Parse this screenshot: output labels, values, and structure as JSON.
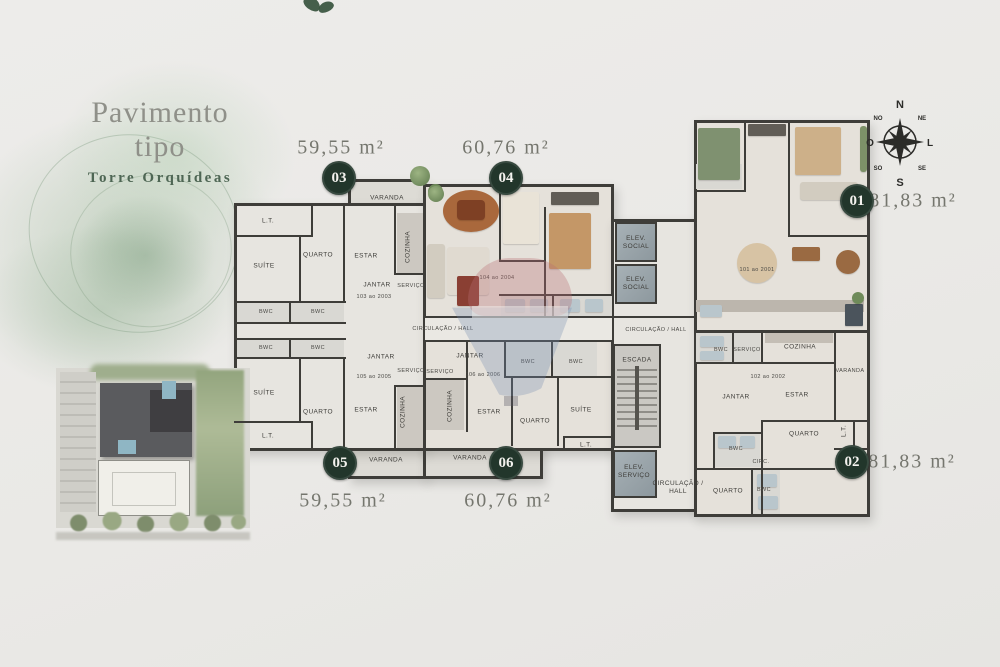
{
  "title_block": {
    "title": "Pavimento tipo",
    "subtitle": "Torre Orquídeas"
  },
  "units": [
    {
      "number": "03",
      "area": "59,55 m²"
    },
    {
      "number": "04",
      "area": "60,76 m²"
    },
    {
      "number": "01",
      "area": "81,83 m²"
    },
    {
      "number": "05",
      "area": "59,55 m²"
    },
    {
      "number": "06",
      "area": "60,76 m²"
    },
    {
      "number": "02",
      "area": "81,83 m²"
    }
  ],
  "compass": {
    "n": "N",
    "ne": "NE",
    "l": "L",
    "se": "SE",
    "s": "S",
    "so": "SO",
    "o": "O",
    "no": "NO"
  },
  "colors": {
    "badge_green": "#22362b",
    "subtitle_green": "#4e6654",
    "title_gray": "#8f9089",
    "area_text": "#75766e",
    "wall": "#3e3d39"
  },
  "plan": {
    "room_labels": [
      {
        "text": "VARANDA",
        "x": 387,
        "y": 198
      },
      {
        "text": "L.T.",
        "x": 268,
        "y": 221
      },
      {
        "text": "SUÍTE",
        "x": 264,
        "y": 266
      },
      {
        "text": "QUARTO",
        "x": 318,
        "y": 255
      },
      {
        "text": "ESTAR",
        "x": 366,
        "y": 256
      },
      {
        "text": "COZINHA",
        "x": 408,
        "y": 247,
        "rot": 1
      },
      {
        "text": "JANTAR",
        "x": 377,
        "y": 285
      },
      {
        "text": "103 ao 2003",
        "x": 374,
        "y": 297,
        "size": "xs"
      },
      {
        "text": "SERVIÇO",
        "x": 411,
        "y": 286,
        "size": "xs"
      },
      {
        "text": "BWC",
        "x": 266,
        "y": 312,
        "size": "xs"
      },
      {
        "text": "BWC",
        "x": 318,
        "y": 312,
        "size": "xs"
      },
      {
        "text": "104 ao 2004",
        "x": 497,
        "y": 278,
        "size": "xs"
      },
      {
        "text": "CIRCULAÇÃO / HALL",
        "x": 443,
        "y": 329,
        "size": "xs"
      },
      {
        "text": "CIRCULAÇÃO / HALL",
        "x": 656,
        "y": 330,
        "size": "xs"
      },
      {
        "text": "BWC",
        "x": 266,
        "y": 348,
        "size": "xs"
      },
      {
        "text": "BWC",
        "x": 318,
        "y": 348,
        "size": "xs"
      },
      {
        "text": "JANTAR",
        "x": 381,
        "y": 357
      },
      {
        "text": "105 ao 2005",
        "x": 374,
        "y": 377,
        "size": "xs"
      },
      {
        "text": "SERVIÇO",
        "x": 411,
        "y": 371,
        "size": "xs"
      },
      {
        "text": "SUÍTE",
        "x": 264,
        "y": 393
      },
      {
        "text": "QUARTO",
        "x": 318,
        "y": 412
      },
      {
        "text": "ESTAR",
        "x": 366,
        "y": 410
      },
      {
        "text": "COZINHA",
        "x": 403,
        "y": 412,
        "rot": 1
      },
      {
        "text": "L.T.",
        "x": 268,
        "y": 436
      },
      {
        "text": "VARANDA",
        "x": 386,
        "y": 460
      },
      {
        "text": "JANTAR",
        "x": 470,
        "y": 356
      },
      {
        "text": "106 ao 2006",
        "x": 483,
        "y": 375,
        "size": "xs"
      },
      {
        "text": "SERVIÇO",
        "x": 440,
        "y": 372,
        "size": "xs"
      },
      {
        "text": "COZINHA",
        "x": 450,
        "y": 406,
        "rot": 1
      },
      {
        "text": "ESTAR",
        "x": 489,
        "y": 412
      },
      {
        "text": "QUARTO",
        "x": 535,
        "y": 421
      },
      {
        "text": "SUÍTE",
        "x": 581,
        "y": 410
      },
      {
        "text": "BWC",
        "x": 528,
        "y": 362,
        "size": "xs"
      },
      {
        "text": "BWC",
        "x": 576,
        "y": 362,
        "size": "xs"
      },
      {
        "text": "L.T.",
        "x": 586,
        "y": 445
      },
      {
        "text": "VARANDA",
        "x": 470,
        "y": 458
      },
      {
        "text": "ELEV. SOCIAL",
        "x": 636,
        "y": 243,
        "w": 34
      },
      {
        "text": "ELEV. SOCIAL",
        "x": 636,
        "y": 284,
        "w": 34
      },
      {
        "text": "ESCADA",
        "x": 637,
        "y": 360
      },
      {
        "text": "ELEV. SERVIÇO",
        "x": 634,
        "y": 472,
        "w": 40
      },
      {
        "text": "CIRCULAÇÃO / HALL",
        "x": 678,
        "y": 488,
        "w": 58
      },
      {
        "text": "101 ao 2001",
        "x": 757,
        "y": 270,
        "size": "xs"
      },
      {
        "text": "BWC",
        "x": 721,
        "y": 350,
        "size": "xs"
      },
      {
        "text": "SERVIÇO",
        "x": 747,
        "y": 350,
        "size": "xs"
      },
      {
        "text": "COZINHA",
        "x": 800,
        "y": 347
      },
      {
        "text": "VARANDA",
        "x": 850,
        "y": 371,
        "size": "xs"
      },
      {
        "text": "102 ao 2002",
        "x": 768,
        "y": 377,
        "size": "xs"
      },
      {
        "text": "JANTAR",
        "x": 736,
        "y": 397
      },
      {
        "text": "ESTAR",
        "x": 797,
        "y": 395
      },
      {
        "text": "QUARTO",
        "x": 804,
        "y": 434
      },
      {
        "text": "L.T.",
        "x": 844,
        "y": 431,
        "rot": 1
      },
      {
        "text": "BWC",
        "x": 736,
        "y": 449,
        "size": "xs"
      },
      {
        "text": "CIRC.",
        "x": 761,
        "y": 462,
        "size": "xs"
      },
      {
        "text": "QUARTO",
        "x": 728,
        "y": 491
      },
      {
        "text": "BWC",
        "x": 764,
        "y": 490,
        "size": "xs"
      }
    ]
  }
}
